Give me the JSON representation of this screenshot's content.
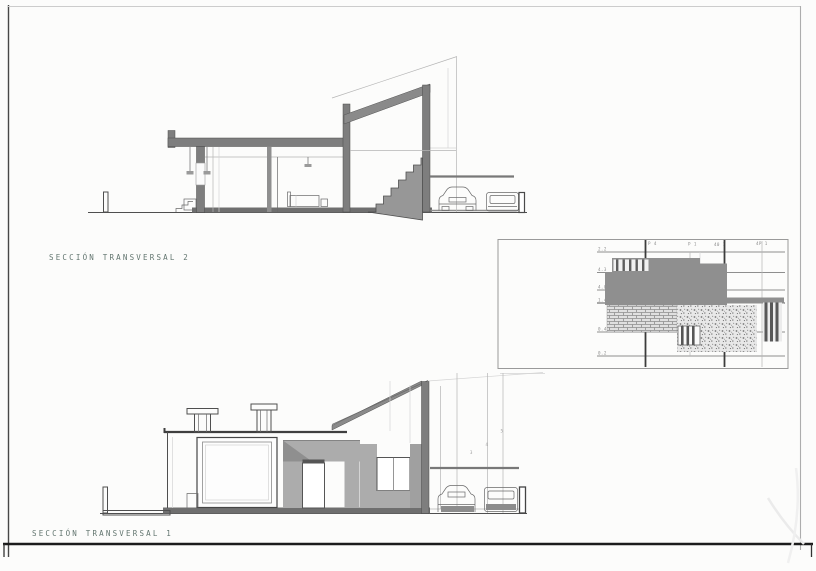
{
  "sheet": {
    "background": "#fcfcfb",
    "frame_color": "#1c1c1c"
  },
  "titles": {
    "section2": "SECCIÓN TRANSVERSAL 2",
    "section1": "SECCIÓN TRANSVERSAL 1"
  },
  "detail_panel": {
    "level_labels": [
      "2.2",
      "4.3",
      "4.0",
      "1.4",
      "0.4",
      "0.2"
    ],
    "column_labels": [
      "P 4",
      "P 1",
      "40 1",
      "4P 1"
    ]
  },
  "dimension_marks": [
    "3",
    "4",
    "5"
  ],
  "palette": {
    "line": "#4f4f4f",
    "cut_wall": "#7e7e7e",
    "roof_band": "#8a8a8a",
    "shade": "#acacac",
    "title_color": "#62756f"
  }
}
